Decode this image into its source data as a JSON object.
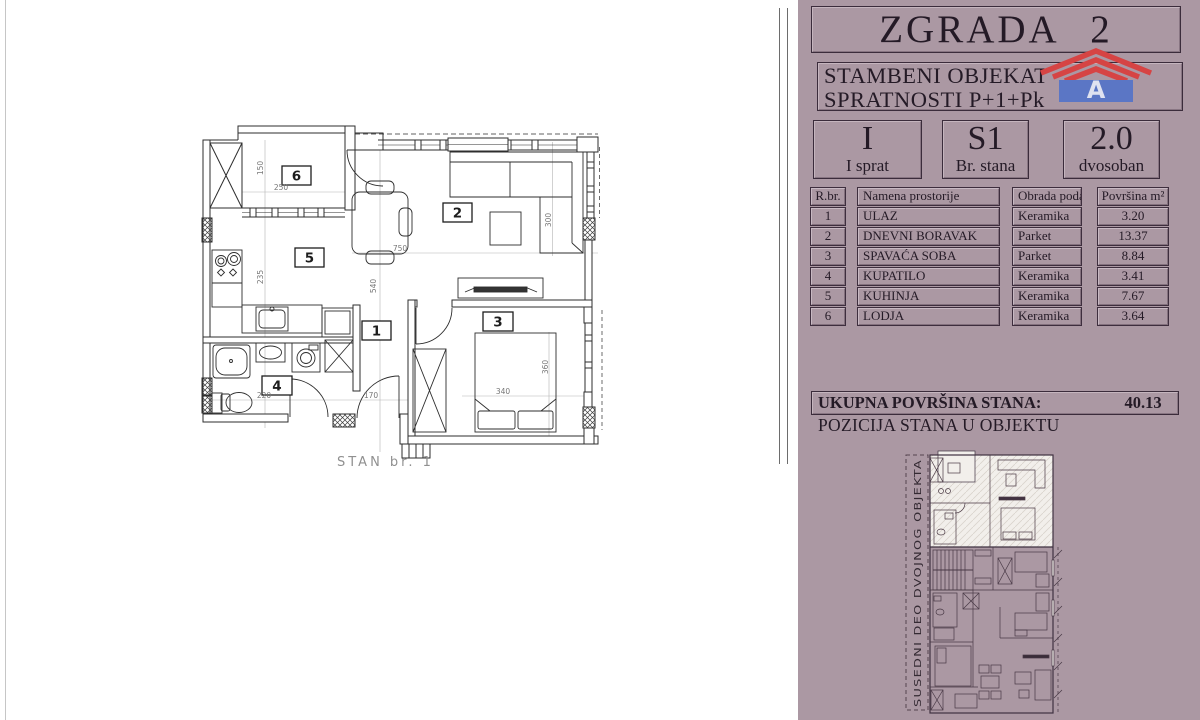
{
  "panel": {
    "title": "ZGRADA 2",
    "subtitle_line1": "STAMBENI OBJEKAT",
    "subtitle_line2": "SPRATNOSTI P+1+Pk",
    "logo": {
      "letter": "A",
      "red": "#d64444",
      "blue": "#5b76c5"
    },
    "info_boxes": [
      {
        "value": "I",
        "label": "I sprat"
      },
      {
        "value": "S1",
        "label": "Br. stana"
      },
      {
        "value": "2.0",
        "label": "dvosoban"
      }
    ],
    "table": {
      "headers": {
        "num": "R.br.",
        "name": "Namena prostorije",
        "floor": "Obrada poda",
        "area": "Površina  m²"
      },
      "rows": [
        {
          "num": "1",
          "name": "ULAZ",
          "floor": "Keramika",
          "area": "3.20"
        },
        {
          "num": "2",
          "name": "DNEVNI BORAVAK",
          "floor": "Parket",
          "area": "13.37"
        },
        {
          "num": "3",
          "name": "SPAVAĆA SOBA",
          "floor": "Parket",
          "area": "8.84"
        },
        {
          "num": "4",
          "name": "KUPATILO",
          "floor": "Keramika",
          "area": "3.41"
        },
        {
          "num": "5",
          "name": "KUHINJA",
          "floor": "Keramika",
          "area": "7.67"
        },
        {
          "num": "6",
          "name": "LODJA",
          "floor": "Keramika",
          "area": "3.64"
        }
      ]
    },
    "total_label": "UKUPNA POVRŠINA STANA:",
    "total_value": "40.13",
    "position_label": "POZICIJA STANA  U OBJEKTU",
    "mini_plan_side_text": "SUSEDNI DEO DVOJNOG OBJEKTA"
  },
  "plan": {
    "name_label": "STAN br. 1",
    "room_numbers": [
      "6",
      "2",
      "5",
      "1",
      "4",
      "3"
    ],
    "dims": [
      "150",
      "250",
      "235",
      "750",
      "540",
      "300",
      "220",
      "170",
      "340",
      "360"
    ]
  },
  "colors": {
    "panel_background": "#ab98a3",
    "panel_text": "#241a26",
    "plan_lines": "#2e2e2e",
    "dim_text": "#777777",
    "logo_red": "#d64444",
    "logo_blue": "#5b76c5"
  }
}
